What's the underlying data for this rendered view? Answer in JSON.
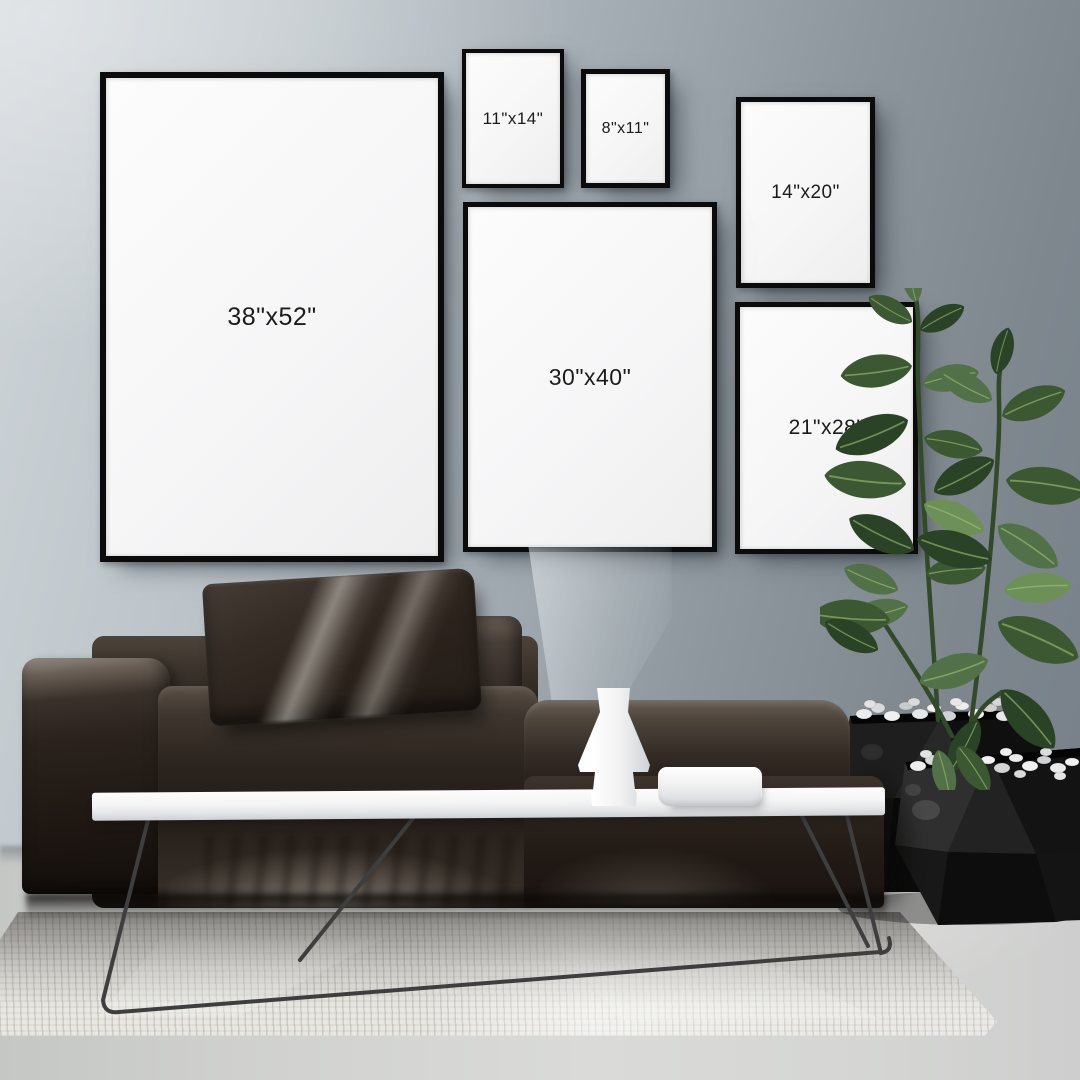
{
  "scene": {
    "name": "poster-size-mockup-living-room"
  },
  "frames": [
    {
      "id": "38x52",
      "label": "38\"x52\""
    },
    {
      "id": "11x14",
      "label": "11\"x14\""
    },
    {
      "id": "8x11",
      "label": "8\"x11\""
    },
    {
      "id": "14x20",
      "label": "14\"x20\""
    },
    {
      "id": "30x40",
      "label": "30\"x40\""
    },
    {
      "id": "21x28",
      "label": "21\"x28\""
    }
  ],
  "colors": {
    "wall": "#9aa3aa",
    "frame_border": "#0b0b0b",
    "poster": "#f7f7f8",
    "label_text": "#1b1b1b",
    "sofa": "#241d18",
    "table": "#f4f4f5",
    "rug": "#e8e7e2",
    "floor": "#d3d4d2",
    "plant_leaf": "#3b5833",
    "planter": "#141414"
  }
}
